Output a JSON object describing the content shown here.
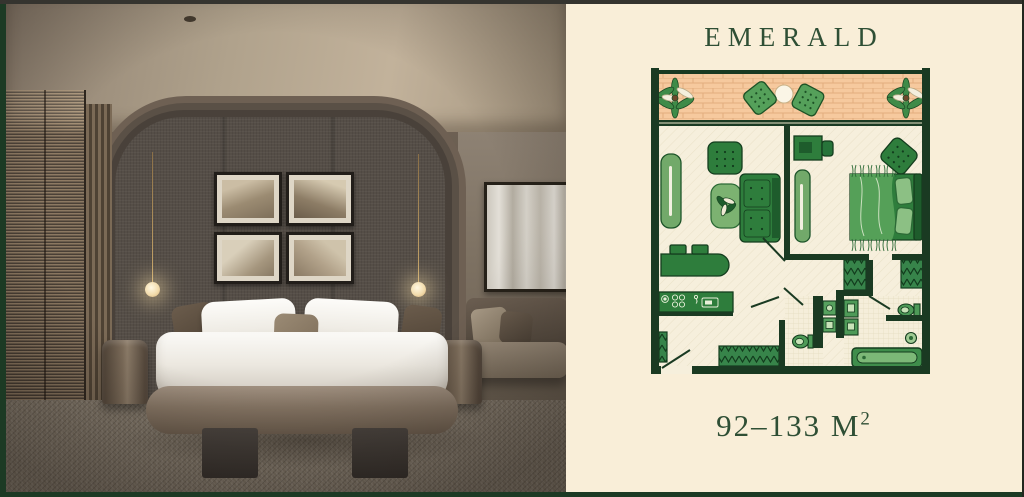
{
  "panel": {
    "title": "EMERALD",
    "area_value": "92–133 M",
    "area_sup": "2"
  },
  "floorplan": {
    "rooms": [
      "balcony",
      "living-room",
      "kitchen",
      "bedroom",
      "hallway",
      "wc",
      "bathroom"
    ],
    "area_range_sqm": [
      92,
      133
    ]
  },
  "colors": {
    "panel_bg": "#f9eed8",
    "title_green": "#2f4f35",
    "plan_wall_green": "#1a3a22",
    "furniture_green": "#2e7d3c",
    "balcony_floor_peach": "#f6c99e",
    "frame_border_green": "#1c3a24"
  }
}
